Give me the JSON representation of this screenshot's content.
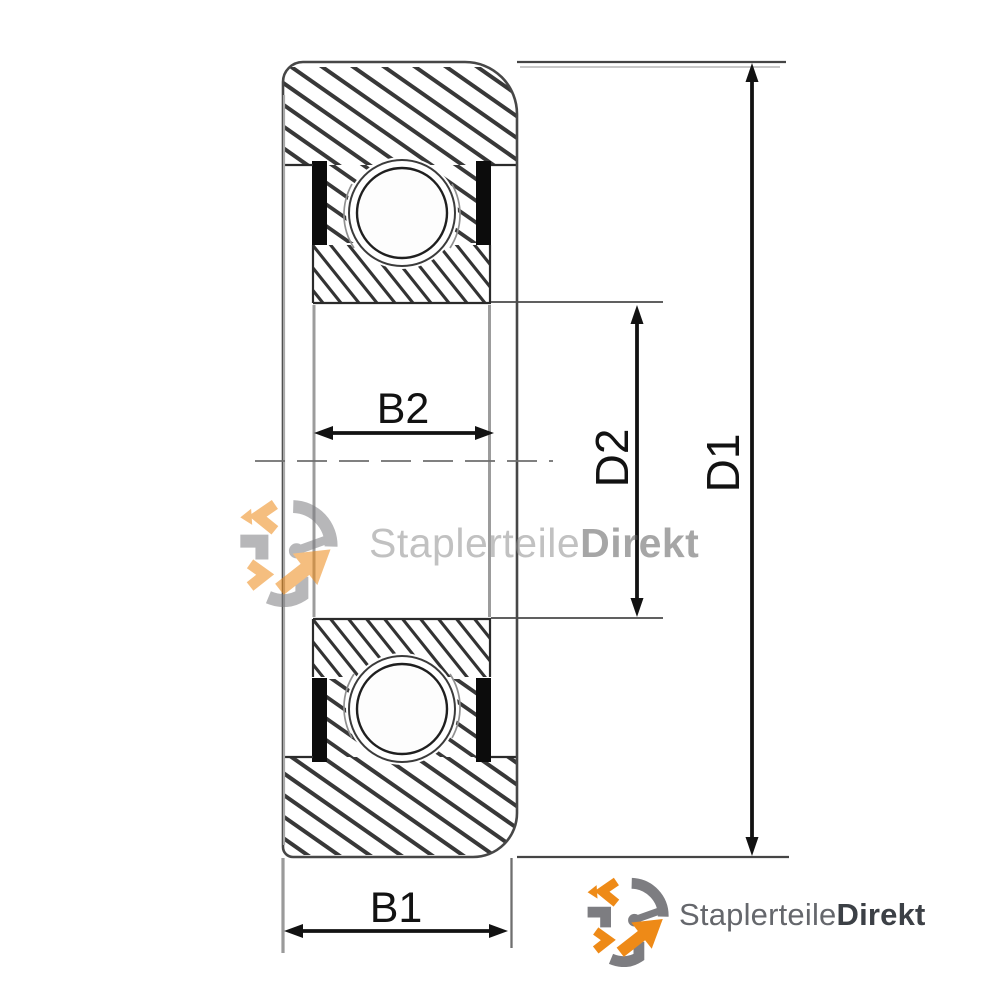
{
  "diagram": {
    "type": "bearing-cross-section",
    "dimension_labels": {
      "b1": "B1",
      "b2": "B2",
      "d1": "D1",
      "d2": "D2"
    }
  },
  "watermark": {
    "brand_regular": "Staplerteile",
    "brand_bold": "Direkt"
  },
  "footer_logo": {
    "brand_regular": "Staplerteile",
    "brand_bold": "Direkt"
  },
  "colors": {
    "background": "#ffffff",
    "outline": "#474747",
    "hatch_outer": "#383838",
    "hatch_inner": "#333333",
    "seal": "#0c0c0c",
    "dimension": "#121212",
    "extension_line": "#4a4a4a",
    "centerline": "#6e6e6e",
    "bore_line": "#9c9c9c",
    "brand_orange": "#ee8a17",
    "brand_gray": "#7d7d81",
    "logo_text_regular": "#65676c",
    "logo_text_bold": "#3c4046",
    "watermark_text_regular": "#8f8f8f",
    "watermark_text_bold": "#5f5f5f"
  }
}
